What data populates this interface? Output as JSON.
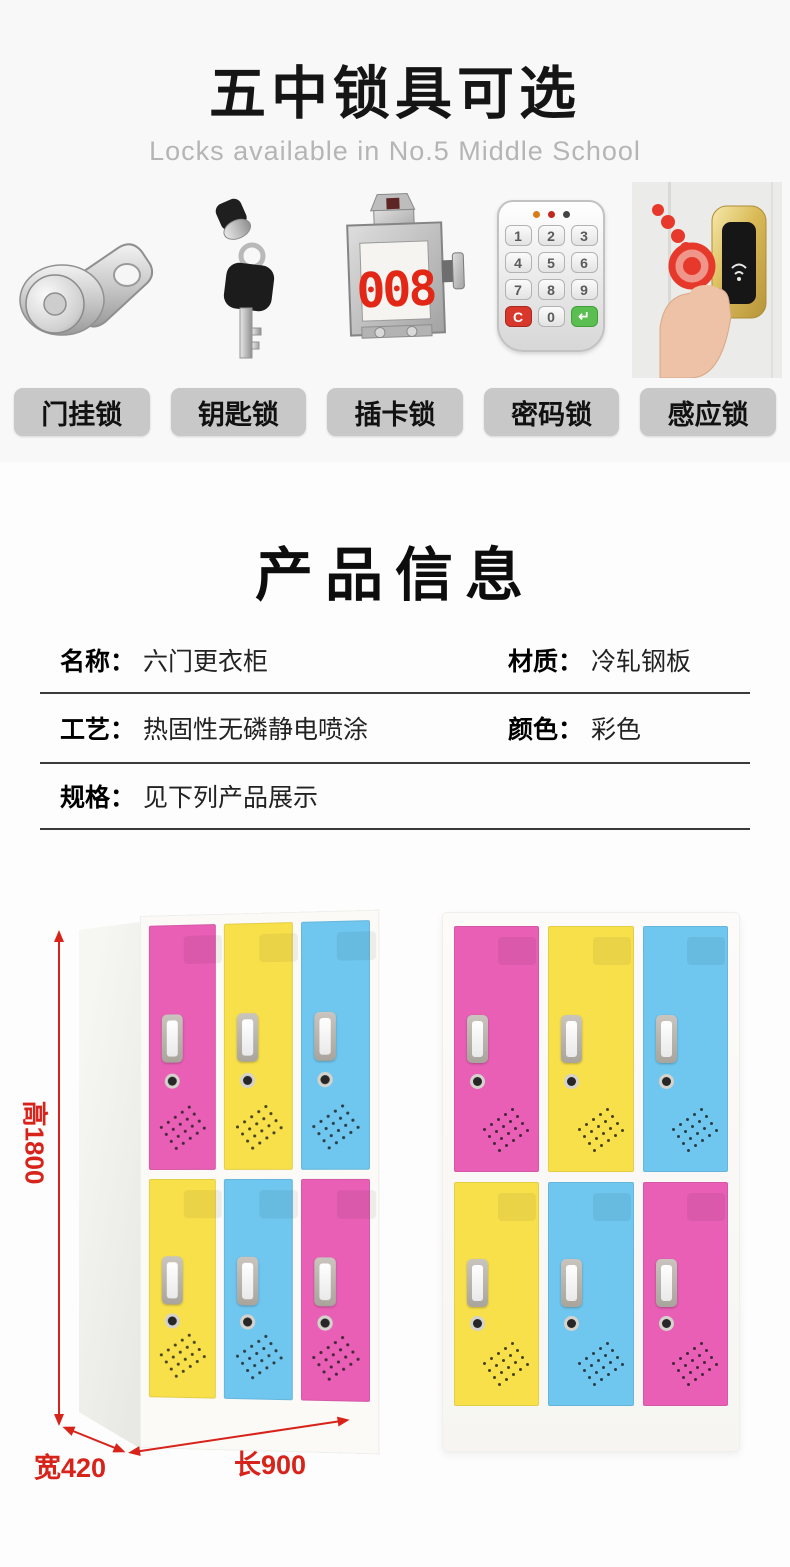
{
  "colors": {
    "pink": "#e85fb5",
    "yellow": "#f8e04b",
    "blue": "#6fc6ee",
    "dimension_red": "#d8231b",
    "header_bg": "#f8f8f8",
    "chip_bg": "#c8c8c8"
  },
  "lock_section": {
    "title": "五中锁具可选",
    "subtitle": "Locks available in No.5 Middle School",
    "locks": [
      {
        "label": "门挂锁",
        "icon": "cam-lock-icon"
      },
      {
        "label": "钥匙锁",
        "icon": "key-lock-icon"
      },
      {
        "label": "插卡锁",
        "icon": "card-lock-icon",
        "display_number": "008"
      },
      {
        "label": "密码锁",
        "icon": "keypad-lock-icon",
        "keys": [
          "1",
          "2",
          "3",
          "4",
          "5",
          "6",
          "7",
          "8",
          "9",
          "C",
          "0",
          "↵"
        ]
      },
      {
        "label": "感应锁",
        "icon": "rfid-lock-icon"
      }
    ]
  },
  "product_info": {
    "title": "产品信息",
    "rows": [
      [
        {
          "label": "名称：",
          "value": "六门更衣柜"
        },
        {
          "label": "材质：",
          "value": "冷轧钢板"
        }
      ],
      [
        {
          "label": "工艺：",
          "value": "热固性无磷静电喷涂"
        },
        {
          "label": "颜色：",
          "value": "彩色"
        }
      ],
      [
        {
          "label": "规格：",
          "value": "见下列产品展示"
        }
      ]
    ]
  },
  "product_display": {
    "dimensions": {
      "height": "高1800",
      "width": "宽420",
      "length": "长900"
    },
    "left_locker_doors": [
      [
        "pink",
        "yellow",
        "blue"
      ],
      [
        "yellow",
        "blue",
        "pink"
      ]
    ],
    "right_locker_doors": [
      [
        "pink",
        "yellow",
        "blue"
      ],
      [
        "yellow",
        "blue",
        "pink"
      ]
    ]
  }
}
